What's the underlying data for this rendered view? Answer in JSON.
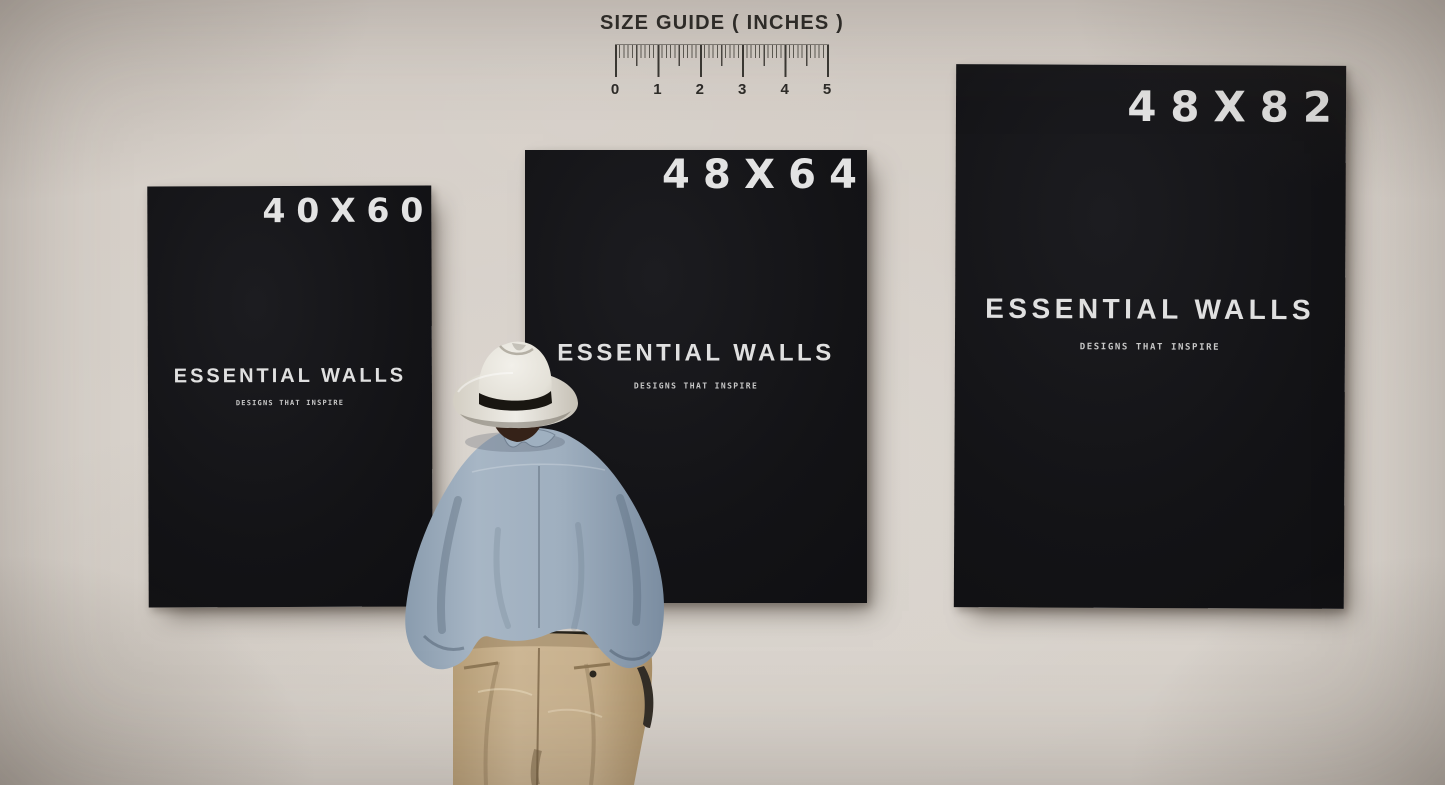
{
  "size_guide": {
    "title": "SIZE GUIDE ( INCHES )",
    "ruler_labels": [
      "0",
      "1",
      "2",
      "3",
      "4",
      "5"
    ]
  },
  "posters": [
    {
      "size_label": "40X60",
      "brand": "ESSENTIAL WALLS",
      "tagline": "DESIGNS THAT INSPIRE"
    },
    {
      "size_label": "48X64",
      "brand": "ESSENTIAL WALLS",
      "tagline": "DESIGNS THAT INSPIRE"
    },
    {
      "size_label": "48X82",
      "brand": "ESSENTIAL WALLS",
      "tagline": "DESIGNS THAT INSPIRE"
    }
  ],
  "scene": {
    "figure": "man wearing a white fedora, blue shirt and khaki trousers, viewed from behind"
  },
  "colors": {
    "wall": "#d6cfc8",
    "poster_background": "#141417",
    "poster_text": "#e3e3e3",
    "guide_text": "#2d2b28",
    "hat": "#eae7e0",
    "hat_band": "#191611",
    "shirt": "#96a6b7",
    "pants": "#c8b28e"
  }
}
